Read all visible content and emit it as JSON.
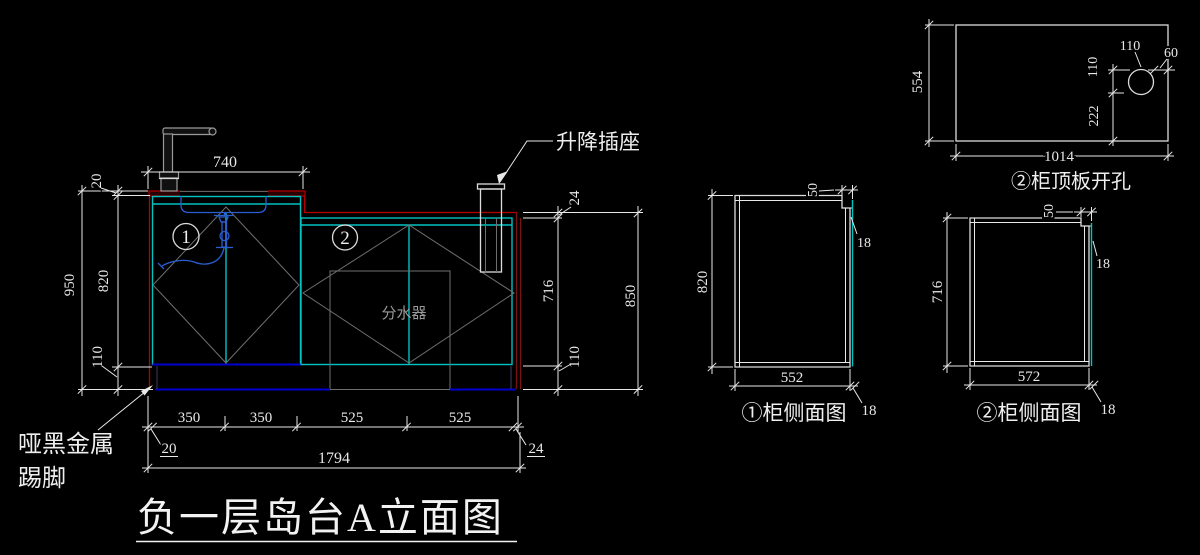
{
  "colors": {
    "background": "#000000",
    "line_white": "#e8e8e8",
    "cabinet_cyan": "#00c3c3",
    "counter_red": "#b40000",
    "kick_blue": "#0000d2",
    "sink_blue": "#2a5ed0",
    "aux_gray": "#6f6f6f"
  },
  "title": {
    "text": "负一层岛台A立面图"
  },
  "elevation": {
    "cabinet1_tag": "1",
    "cabinet2_tag": "2",
    "labels": {
      "socket": "升降插座",
      "kickboard_line1": "哑黑金属",
      "kickboard_line2": "踢脚",
      "distributor": "分水器"
    },
    "dims": {
      "top_width": "740",
      "counter_thickness": "20",
      "total_height": "950",
      "cabinet_height": "820",
      "kick_height": "110",
      "counter2_thickness": "24",
      "cabinet2_height": "716",
      "kick2_height": "110",
      "right_total": "850",
      "offset_left": "20",
      "seg1": "350",
      "seg2": "350",
      "seg3": "525",
      "seg4": "525",
      "offset_right": "24",
      "total_width": "1794"
    }
  },
  "side_view1": {
    "caption": "①柜侧面图",
    "dims": {
      "height": "820",
      "width": "552",
      "top_notch": "50",
      "back_panel": "18",
      "base": "18"
    }
  },
  "side_view2": {
    "caption": "②柜侧面图",
    "dims": {
      "height": "716",
      "width": "572",
      "top_notch": "50",
      "back_panel": "18",
      "base": "18"
    }
  },
  "top_panel": {
    "caption": "②柜顶板开孔",
    "dims": {
      "height": "554",
      "width": "1014",
      "hole_dia": "110",
      "edge_gap": "60",
      "hole_top": "110",
      "hole_bottom": "222"
    }
  }
}
